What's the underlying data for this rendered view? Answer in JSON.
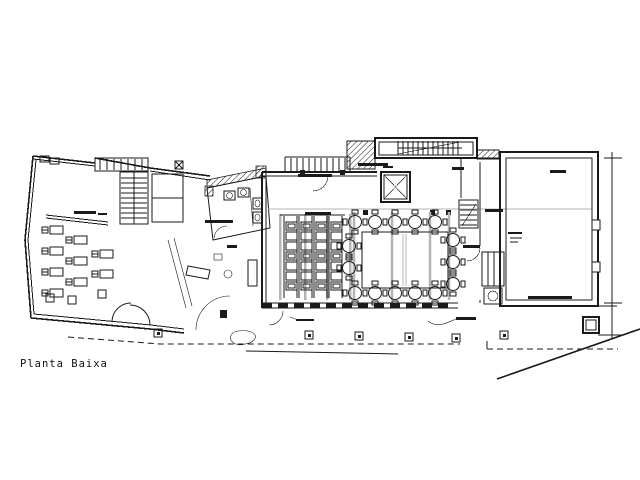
{
  "drawing": {
    "title": "Planta Baixa"
  },
  "colors": {
    "line": "#1a1a1a",
    "muted": "#b4b4b4",
    "bg": "#ffffff"
  }
}
